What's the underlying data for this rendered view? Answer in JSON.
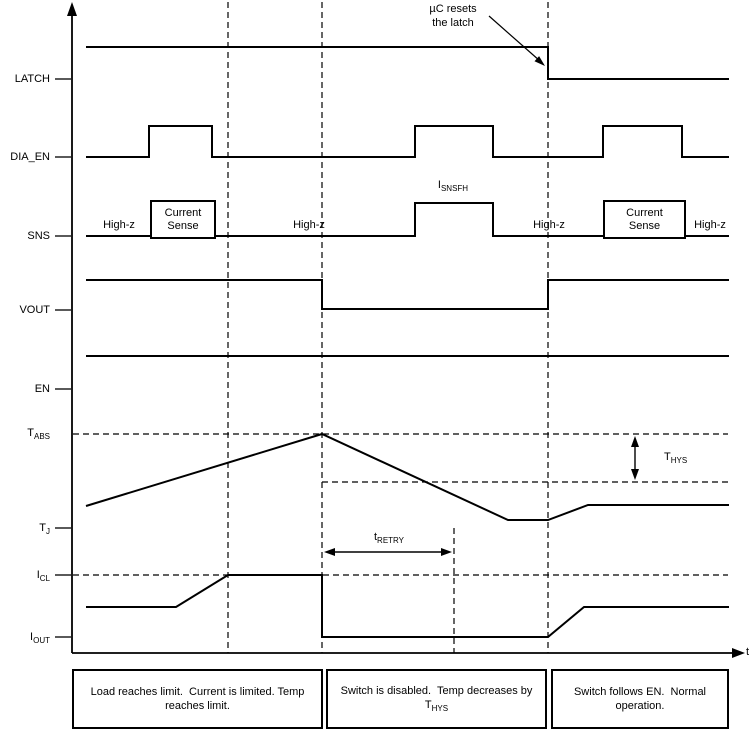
{
  "labels": {
    "latch": "LATCH",
    "dia_en": "DIA_EN",
    "sns": "SNS",
    "vout": "VOUT",
    "en": "EN",
    "t_abs": {
      "base": "T",
      "sub": "ABS"
    },
    "t_j": {
      "base": "T",
      "sub": "J"
    },
    "i_cl": {
      "base": "I",
      "sub": "CL"
    },
    "i_out": {
      "base": "I",
      "sub": "OUT"
    }
  },
  "annotations": {
    "uc_resets": {
      "line1": "µC resets",
      "line2": "the latch"
    },
    "i_snsfh": {
      "base": "I",
      "sub": "SNSFH"
    },
    "t_hys": {
      "base": "T",
      "sub": "HYS"
    },
    "t_retry": {
      "base": "t",
      "sub": "RETRY"
    },
    "high_z": "High-z",
    "current_sense": {
      "line1": "Current",
      "line2": "Sense"
    },
    "time_axis_label": "t"
  },
  "phase_boxes": [
    {
      "line1": "Load reaches limit.  Current is limited. Temp",
      "line2": "reaches limit."
    },
    {
      "line1": "Switch is disabled.  Temp decreases by",
      "line2_base": "T",
      "line2_sub": "HYS"
    },
    {
      "line1": "Switch follows EN.  Normal",
      "line2": "operation."
    }
  ],
  "waveforms": {
    "latch": "86,47 548,47 548,79 729,79",
    "dia_en": "86,157 149,157 149,126 212,126 212,157 415,157 415,126 493,126 493,157 603,157 603,126 682,126 682,157 729,157",
    "sns": "86,236 415,236 415,203 493,203 493,236 729,236",
    "vout": "86,280 322,280 322,309 548,309 548,280 729,280",
    "en": "86,356 729,356",
    "temperature": "86,506 322,434 508,520 548,520 588,505 729,505",
    "current": "86,607 176,607 228,575 322,575 322,637 548,637 584,607 729,607"
  },
  "colors": {
    "line": "#000000",
    "background": "#ffffff"
  }
}
